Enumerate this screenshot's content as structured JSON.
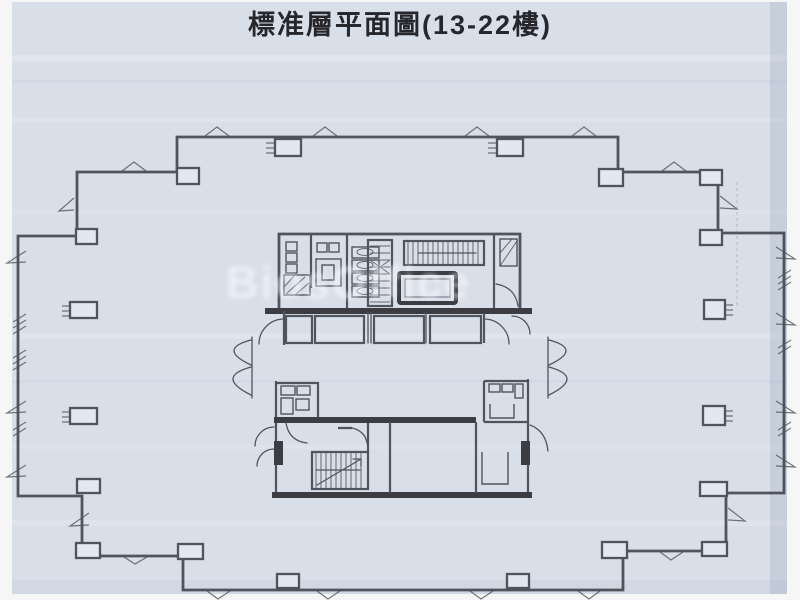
{
  "document": {
    "title": "標准層平面圖(13-22樓)",
    "watermark": "BiosOffice"
  },
  "colors": {
    "margin": "#f6f6f7",
    "paper": "#d9dfe9",
    "ink": "#41454e",
    "ink_dark": "#2a2c32",
    "title": "#26272c",
    "watermark": "#ffffff"
  }
}
